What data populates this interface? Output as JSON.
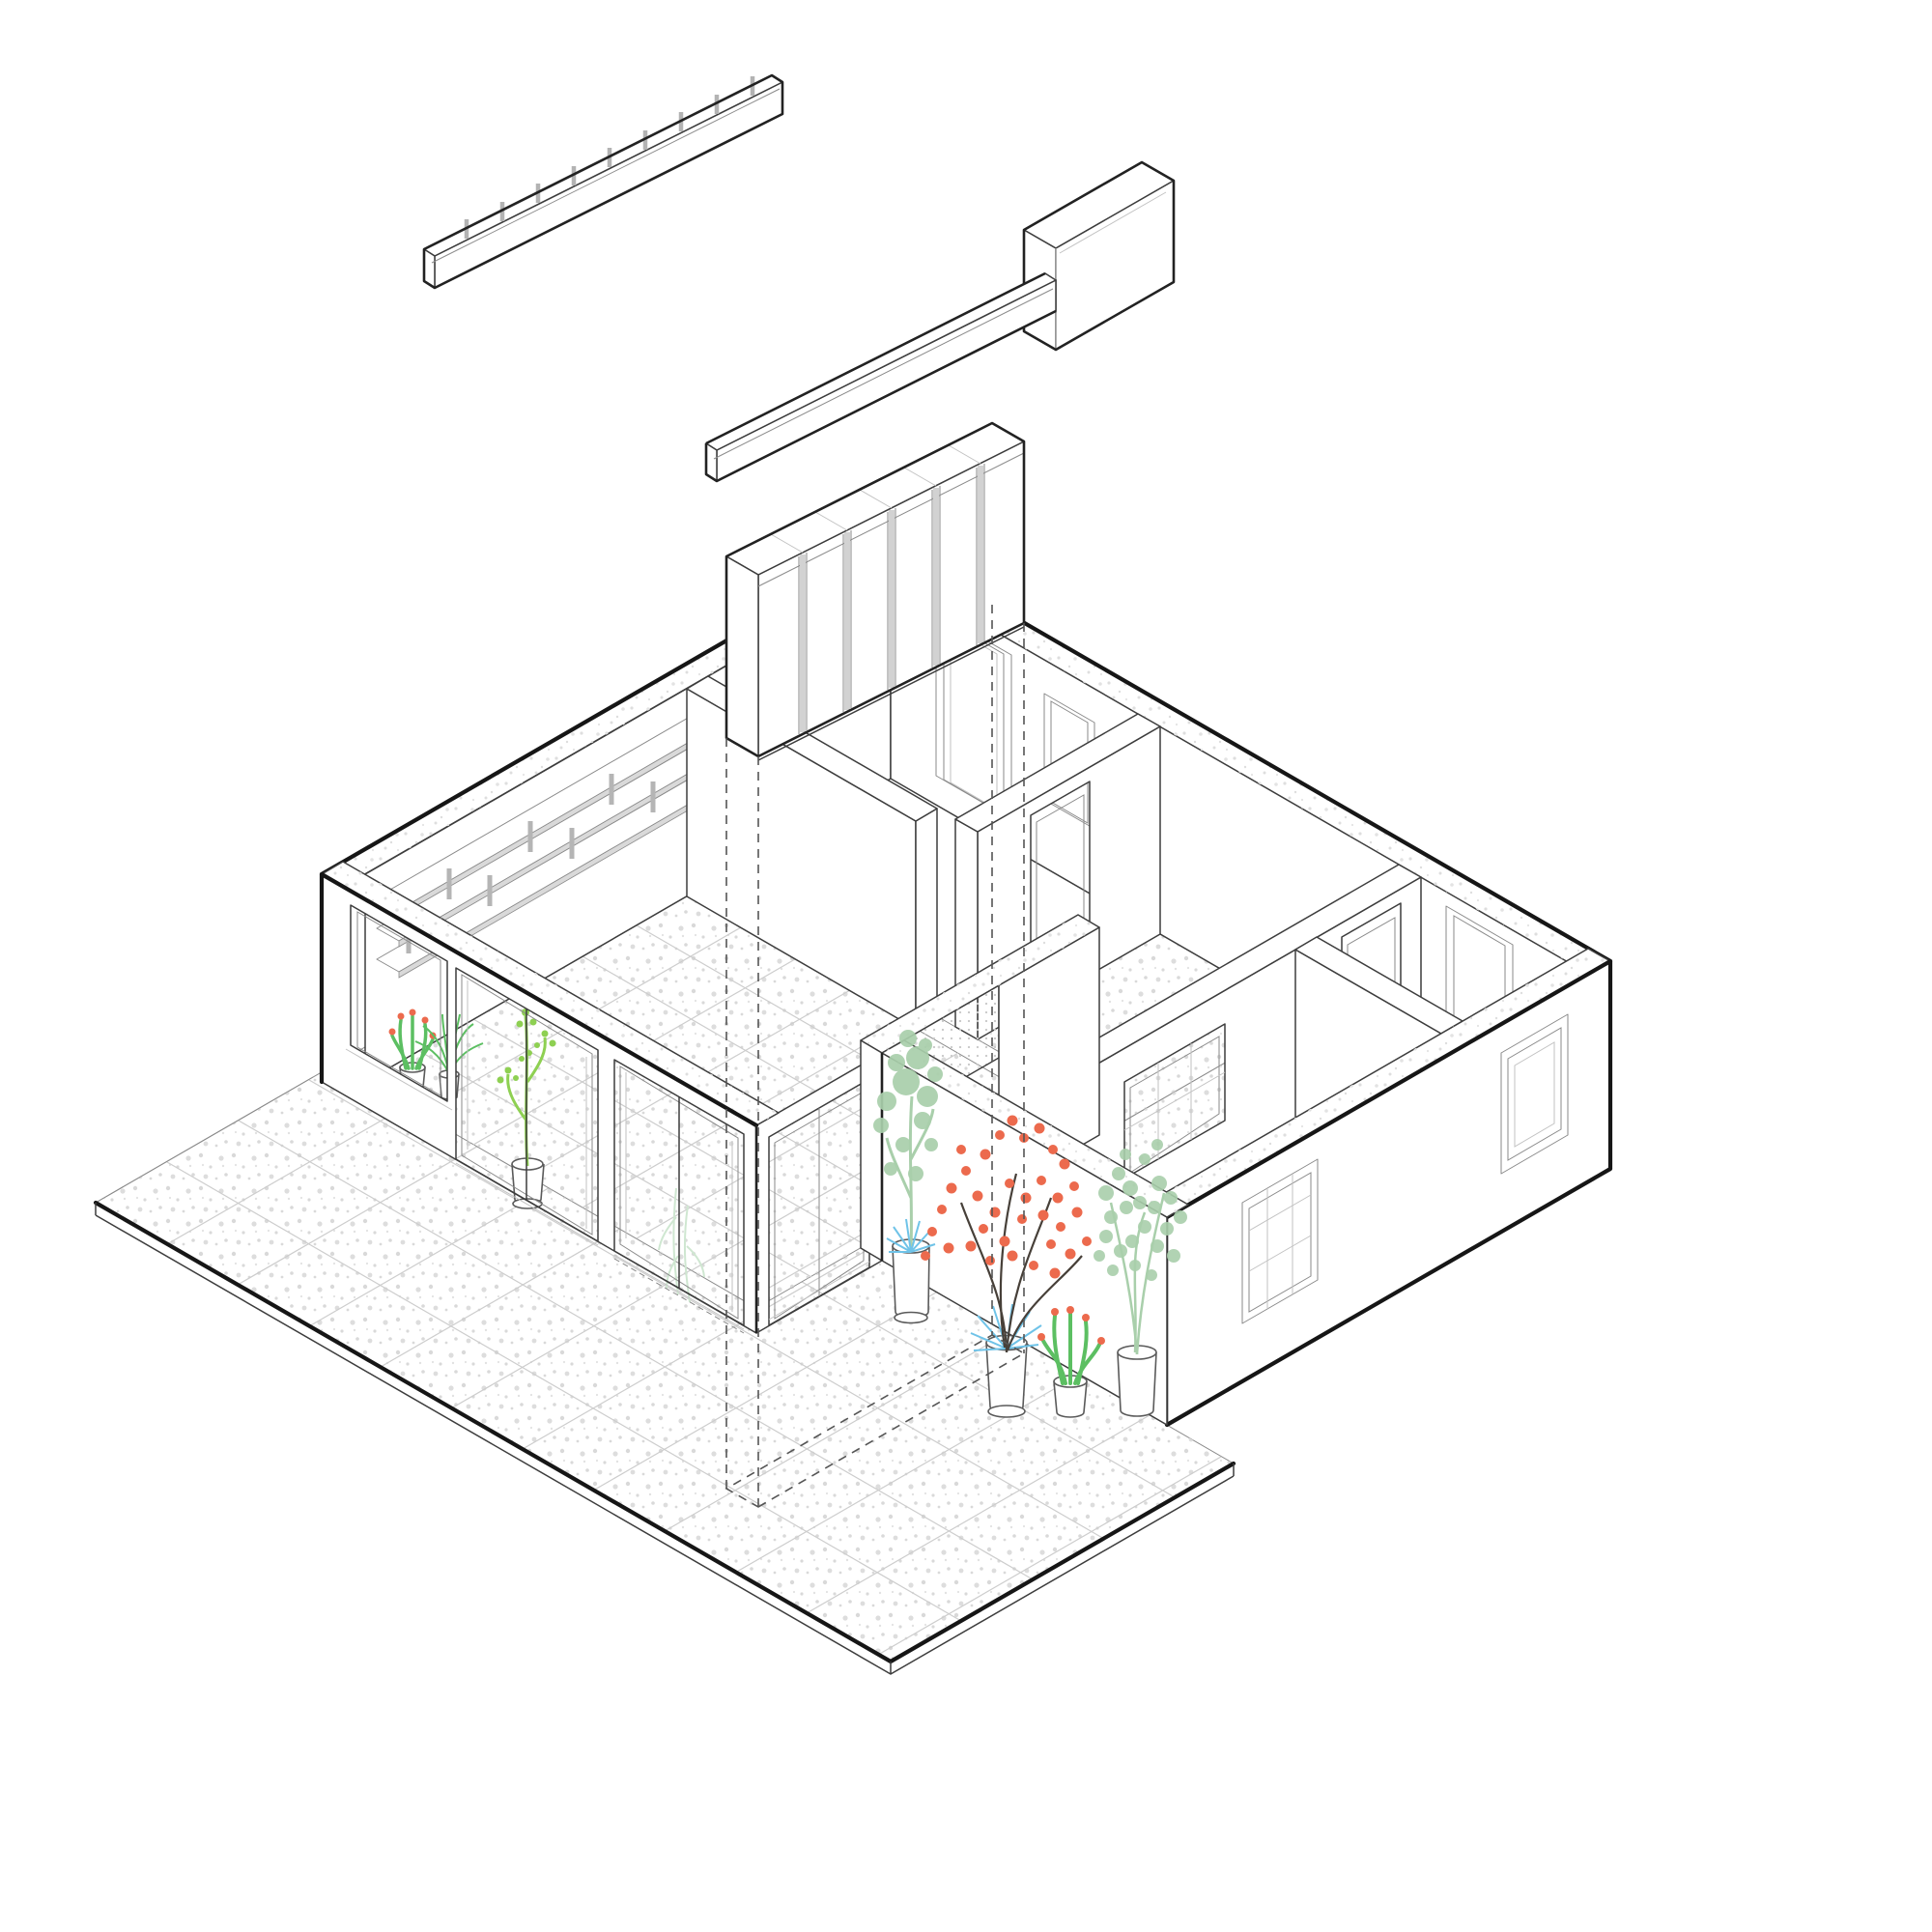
{
  "scene": {
    "type": "axonometric-exploded-interior-diagram",
    "background": "#ffffff",
    "description": "Exploded isometric cutaway drawing of an apartment; three joinery elements float above the plan with dashed projection lines"
  },
  "palette": {
    "line_dark": "#161616",
    "line_mid": "#3d3d3d",
    "line_light": "#8a8a8a",
    "speckle": "#d9d9d9",
    "grid_tile": "#e2e2e2",
    "hatch_dot": "#c9c9c9",
    "plant_pale_green": "#a9cfab",
    "plant_bright_green": "#8ed052",
    "plant_green": "#5cbf62",
    "plant_faint_green": "#cfe7d1",
    "flower_coral": "#ec6a4d",
    "plant_blue": "#6fc3e8",
    "branch_brown": "#474039",
    "pot_stroke": "#5a5a5a"
  },
  "exploded_components": [
    {
      "name": "open-shelf-rail",
      "form": "long open channel beam",
      "divider_tabs": 9
    },
    {
      "name": "counter-with-cabinet",
      "form": "long low bar ending in tall box"
    },
    {
      "name": "wardrobe",
      "form": "slab with vertical door panels",
      "panels": 6,
      "projection_lines": 4
    }
  ],
  "house": {
    "cutaway": "uniform wall cut height, speckled cut tops on perimeter walls",
    "rooms": [
      {
        "name": "living-room",
        "floor": "speckled-tile"
      },
      {
        "name": "bedroom-1",
        "floor": "plain"
      },
      {
        "name": "hall",
        "floor": "speckled-tile"
      },
      {
        "name": "kitchen",
        "floor": "speckled-tile"
      },
      {
        "name": "bathroom",
        "floor": "fine-grid-tile"
      },
      {
        "name": "bedroom-2",
        "floor": "plain"
      },
      {
        "name": "terrace-courtyard",
        "floor": "large speckled tiles"
      }
    ],
    "openings": {
      "facade_window": 1,
      "sliding_glass_doors": 3,
      "back_wall_windows": 2,
      "back_wall_door_frames": 1,
      "right_wall_windows": 2,
      "gridded_windows": 2,
      "interior_door_openings": 2,
      "kitchen_pass_through": 1
    },
    "shelving": {
      "wall": "north-west",
      "boards": 3,
      "divider_tabs": 8
    },
    "plants": [
      {
        "name": "cactus-with-coral-tips",
        "pot": "white cylinder"
      },
      {
        "name": "fan-palm",
        "pot": "white cylinder"
      },
      {
        "name": "bright-green-stem-plant",
        "pot": "white cylinder"
      },
      {
        "name": "faint-silhouette-plants",
        "pot": "none"
      },
      {
        "name": "pale-green-tree",
        "pot": "tall white cylinder"
      },
      {
        "name": "coral-berry-branches",
        "pot": "white cylinder"
      },
      {
        "name": "cactus-with-coral-flowers",
        "pot": "white cylinder"
      },
      {
        "name": "pale-green-tree-2",
        "pot": "white cylinder"
      },
      {
        "name": "blue-spike-plants",
        "count": 2
      }
    ]
  }
}
